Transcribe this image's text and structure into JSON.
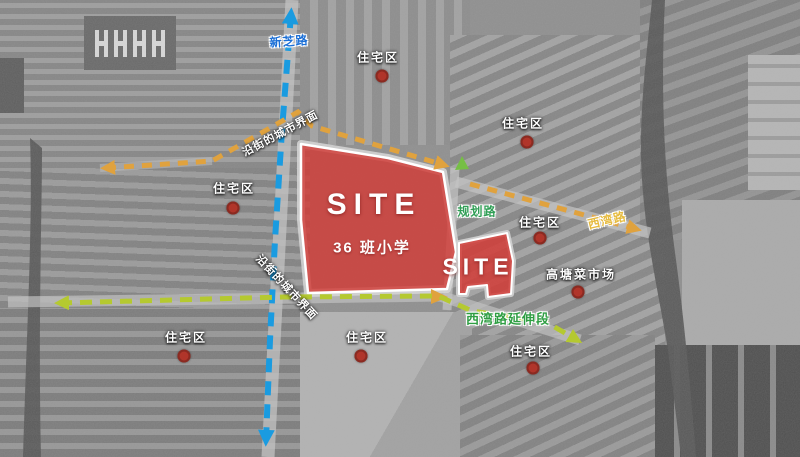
{
  "labels": {
    "xinzhi_road": "新芝路",
    "planned_road": "规划路",
    "xiwan_road": "西湾路",
    "xiwan_extension": "西湾路延伸段",
    "residential": "住宅区",
    "market": "高塘菜市场",
    "interface_upper": "沿街的城市界面",
    "interface_lower": "沿街的城市界面",
    "site_main": "SITE",
    "site_main_sub": "36 班小学",
    "site_secondary": "SITE"
  },
  "colors": {
    "xinzhi_line": "#1a9be0",
    "interface_line": "#e0a23e",
    "extension_line": "#b5c930",
    "site_fill": "#d23c37",
    "marker_dot": "#b0352a",
    "planned_road_text": "#2f9e55",
    "xiwan_road_text": "#e6bb3f",
    "extension_text": "#2f9e43",
    "xinzhi_text": "#1b6fd6"
  }
}
